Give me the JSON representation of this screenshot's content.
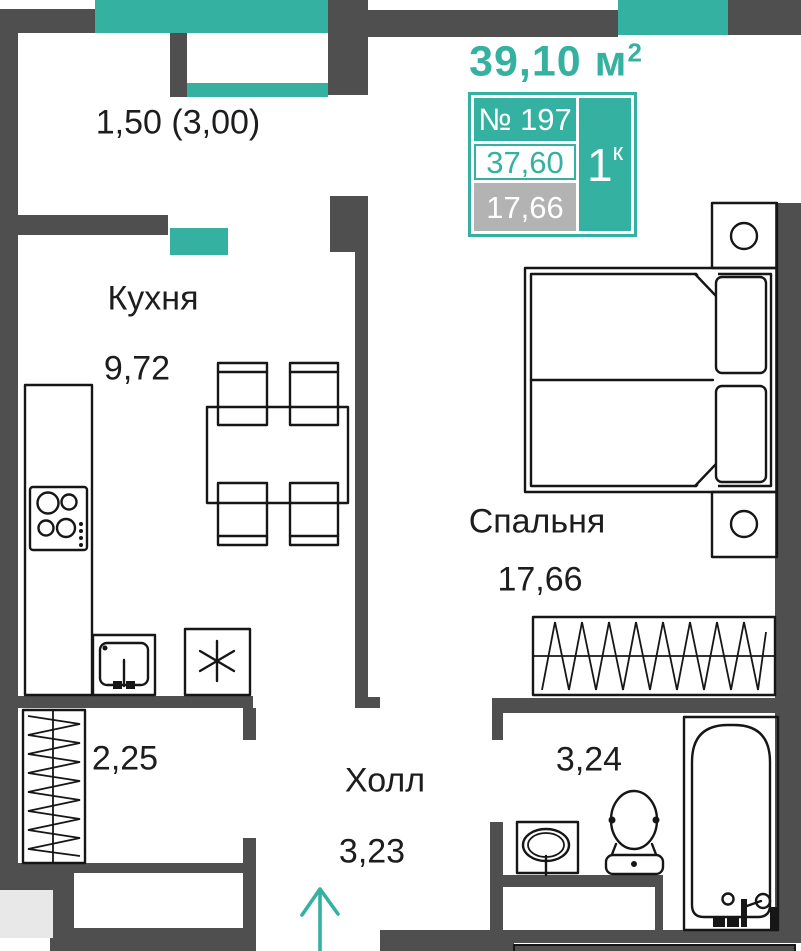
{
  "colors": {
    "teal": "#35b1a1",
    "wall": "#4f4f4f",
    "light": "#e8e8e8",
    "badge": "#b3b3b3",
    "ink": "#1d1d1d"
  },
  "header": {
    "total_area": "39,10 м",
    "total_area_sup": "2"
  },
  "unit_card": {
    "number": "№ 197",
    "area_total": "37,60",
    "area_living": "17,66",
    "rooms_value": "1",
    "rooms_sup": "к"
  },
  "rooms": {
    "balcony": {
      "area_note": "1,50 (3,00)"
    },
    "kitchen": {
      "name": "Кухня",
      "area": "9,72"
    },
    "bedroom": {
      "name": "Спальня",
      "area": "17,66"
    },
    "hall": {
      "name": "Холл",
      "area": "3,23"
    },
    "bathroom": {
      "area": "3,24"
    },
    "wardrobe": {
      "area": "2,25"
    }
  },
  "icons": {
    "entrance_arrow": "arrow-up",
    "cabinet_mark": "asterisk"
  }
}
